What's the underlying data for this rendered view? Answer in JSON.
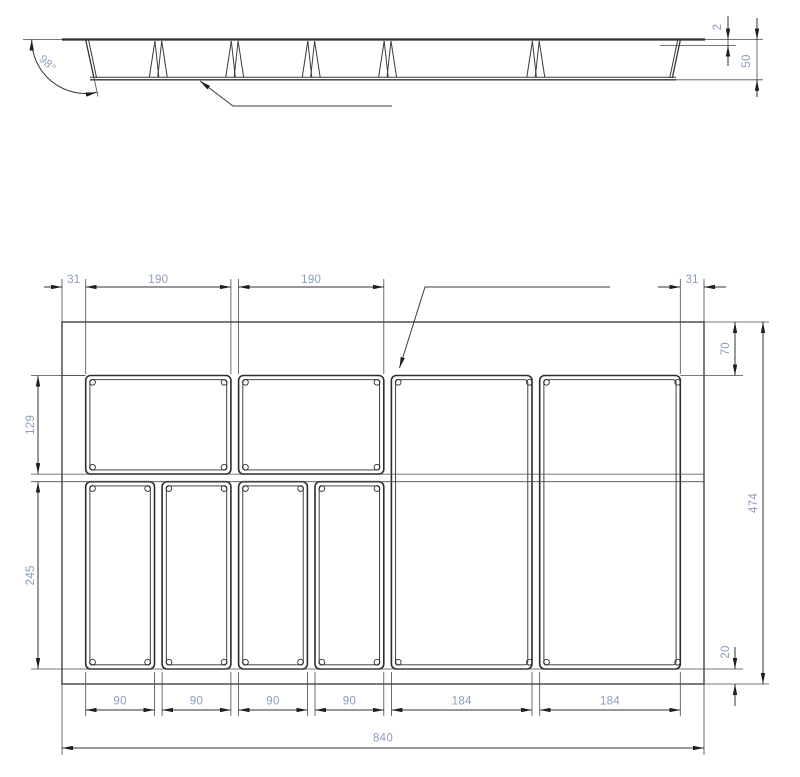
{
  "section_view": {
    "angle": "98°",
    "rim_thickness": "2",
    "height": "50"
  },
  "plan_view": {
    "top_dims": [
      "31",
      "190",
      "190",
      "31"
    ],
    "left_dims": [
      "129",
      "245"
    ],
    "right_dims": [
      "70",
      "474",
      "20"
    ],
    "bottom_dims": [
      "90",
      "90",
      "90",
      "90",
      "184",
      "184"
    ],
    "overall_width": "840"
  },
  "colors": {
    "line": "#3a3a3a",
    "dimension_text": "#8d9cba"
  }
}
